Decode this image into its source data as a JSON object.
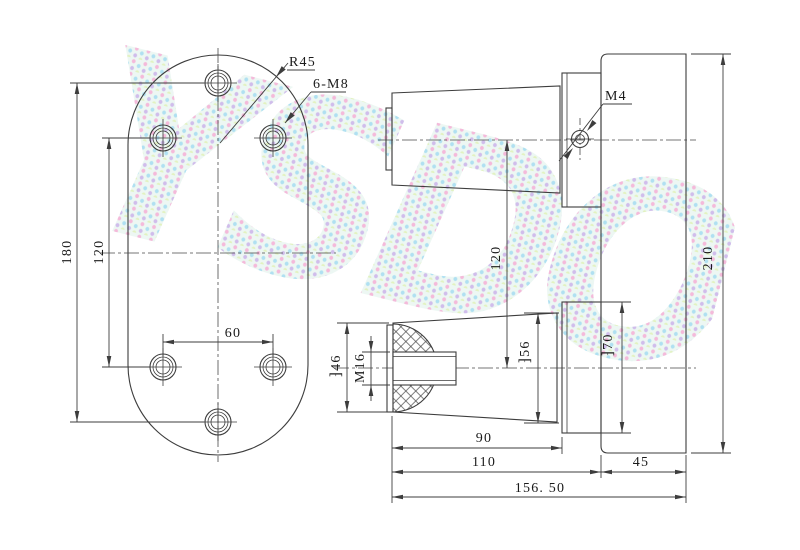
{
  "drawing": {
    "watermark": "YSDO",
    "front_view": {
      "radius_label": "R45",
      "holes_label": "6-M8",
      "dim_height": "180",
      "dim_row_spacing": "120",
      "dim_hole_spacing": "60"
    },
    "side_view": {
      "thread_label": "M4",
      "dim_axis_spacing": "120",
      "dim_overall_height": "210",
      "dim_bore_outer": "⁆46",
      "dim_thread": "M16",
      "dim_boss_dia": "⁆56",
      "dim_flange_dia": "⁆70",
      "dim_boss_length": "90",
      "dim_to_body": "110",
      "dim_body_width": "45",
      "dim_overall_length": "156. 50"
    },
    "colors": {
      "line": "#3d3d3d",
      "text": "#1a1a1a",
      "background": "#ffffff"
    }
  }
}
